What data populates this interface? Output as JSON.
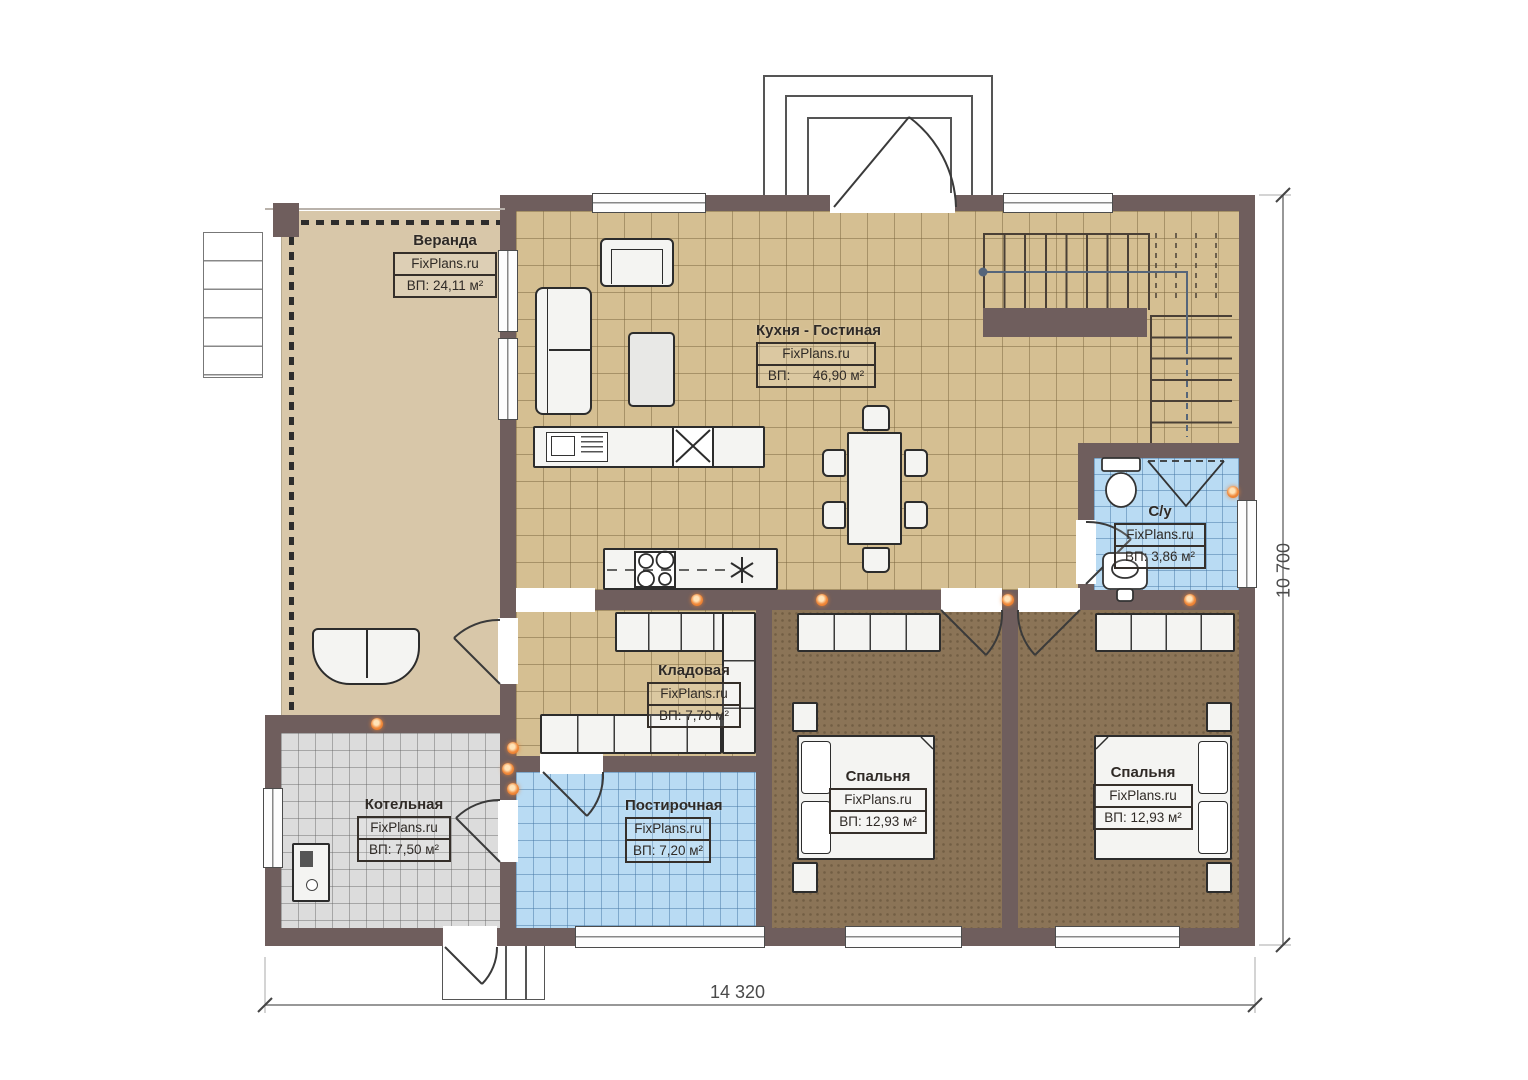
{
  "plan": {
    "brand": "FixPlans.ru",
    "rooms": {
      "veranda": {
        "name": "Веранда",
        "area": "ВП: 24,11 м²"
      },
      "kitchen_living": {
        "name": "Кухня - Гостиная",
        "area": "ВП:      46,90 м²"
      },
      "bathroom": {
        "name": "С/у",
        "area": "ВП: 3,86 м²"
      },
      "storage": {
        "name": "Кладовая",
        "area": "ВП: 7,70 м²"
      },
      "boiler": {
        "name": "Котельная",
        "area": "ВП: 7,50 м²"
      },
      "laundry": {
        "name": "Постирочная",
        "area": "ВП: 7,20 м²"
      },
      "bedroom1": {
        "name": "Спальня",
        "area": "ВП: 12,93 м²"
      },
      "bedroom2": {
        "name": "Спальня",
        "area": "ВП: 12,93 м²"
      }
    },
    "dimensions": {
      "width": "14 320",
      "height": "10 700"
    },
    "colors": {
      "wall": "#6f5e5d",
      "floor_veranda": "#d8c7a9",
      "floor_tile_tan": "#d5bf92",
      "floor_tile_blue": "#b9dbf3",
      "floor_tile_grey": "#dcdcdc",
      "floor_bedroom": "#8b7457",
      "accent_light": "#f08a3c"
    }
  }
}
